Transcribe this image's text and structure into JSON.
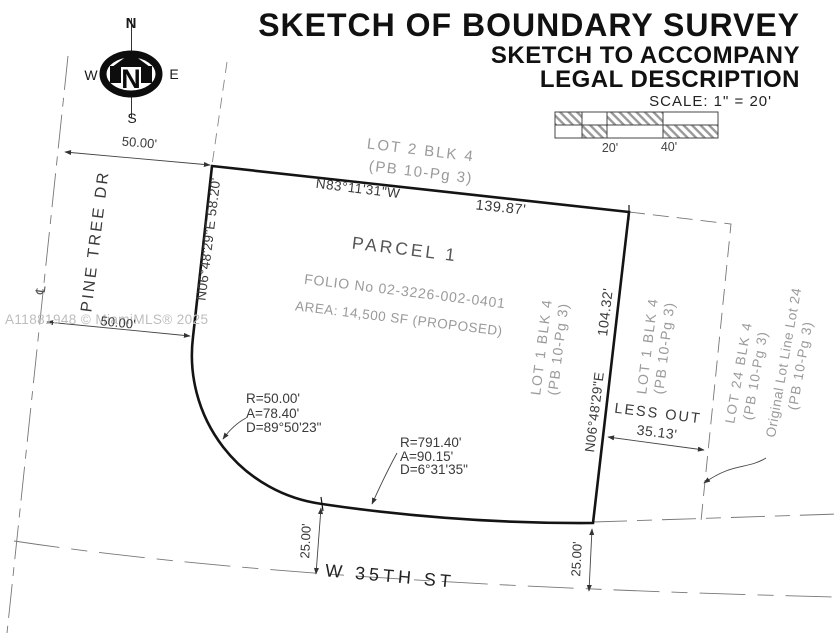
{
  "header": {
    "title1": "SKETCH OF BOUNDARY SURVEY",
    "title2": "SKETCH TO ACCOMPANY",
    "title3": "LEGAL DESCRIPTION",
    "scale_label": "SCALE:  1\" =  20'",
    "scale_tick_20": "20'",
    "scale_tick_40": "40'"
  },
  "compass": {
    "north": "N",
    "south": "S",
    "east": "E",
    "west": "W",
    "hub": "N"
  },
  "watermark": {
    "text": "A11881948 © MiamiMLS® 2025"
  },
  "streets": {
    "pine_tree_dr": "PINE TREE DR",
    "w_35th_st": "W 35TH ST",
    "centerline_symbol": "℄"
  },
  "parcel": {
    "name": "PARCEL 1",
    "folio": "FOLIO No 02-3226-002-0401",
    "area": "AREA: 14,500 SF (PROPOSED)"
  },
  "bearings": {
    "north_bearing": "N83°11'31\"W",
    "north_distance": "139.87'",
    "west_bearing_distance": "N06°48'29\"E  58.20'",
    "east_distance": "104.32'",
    "east_bearing": "N06°48'29\"E"
  },
  "curves": {
    "c1_radius": "R=50.00'",
    "c1_arc": "A=78.40'",
    "c1_delta": "D=89°50'23\"",
    "c2_radius": "R=791.40'",
    "c2_arc": "A=90.15'",
    "c2_delta": "D=6°31'35\""
  },
  "lots": {
    "lot2_name": "LOT 2 BLK 4",
    "lot2_plat": "(PB 10-Pg 3)",
    "lot1_west_name": "LOT 1 BLK 4",
    "lot1_west_plat": "(PB 10-Pg 3)",
    "lot1_east_name": "LOT 1 BLK 4",
    "lot1_east_plat": "(PB 10-Pg 3)",
    "lot24_name": "LOT 24 BLK 4",
    "lot24_plat": "(PB 10-Pg 3)",
    "original_line_name": "Original Lot Line Lot 24",
    "original_line_plat": "(PB 10-Pg 3)"
  },
  "dims": {
    "row_width_top": "50.00'",
    "row_width_bottom": "50.00'",
    "half_row_left": "25.00'",
    "half_row_right": "25.00'",
    "less_out_label": "LESS OUT",
    "less_out_value": "35.13'"
  },
  "colors": {
    "ink": "#1a1a1a",
    "gray_label": "#9a9a9a",
    "watermark": "#bdbdbd"
  }
}
